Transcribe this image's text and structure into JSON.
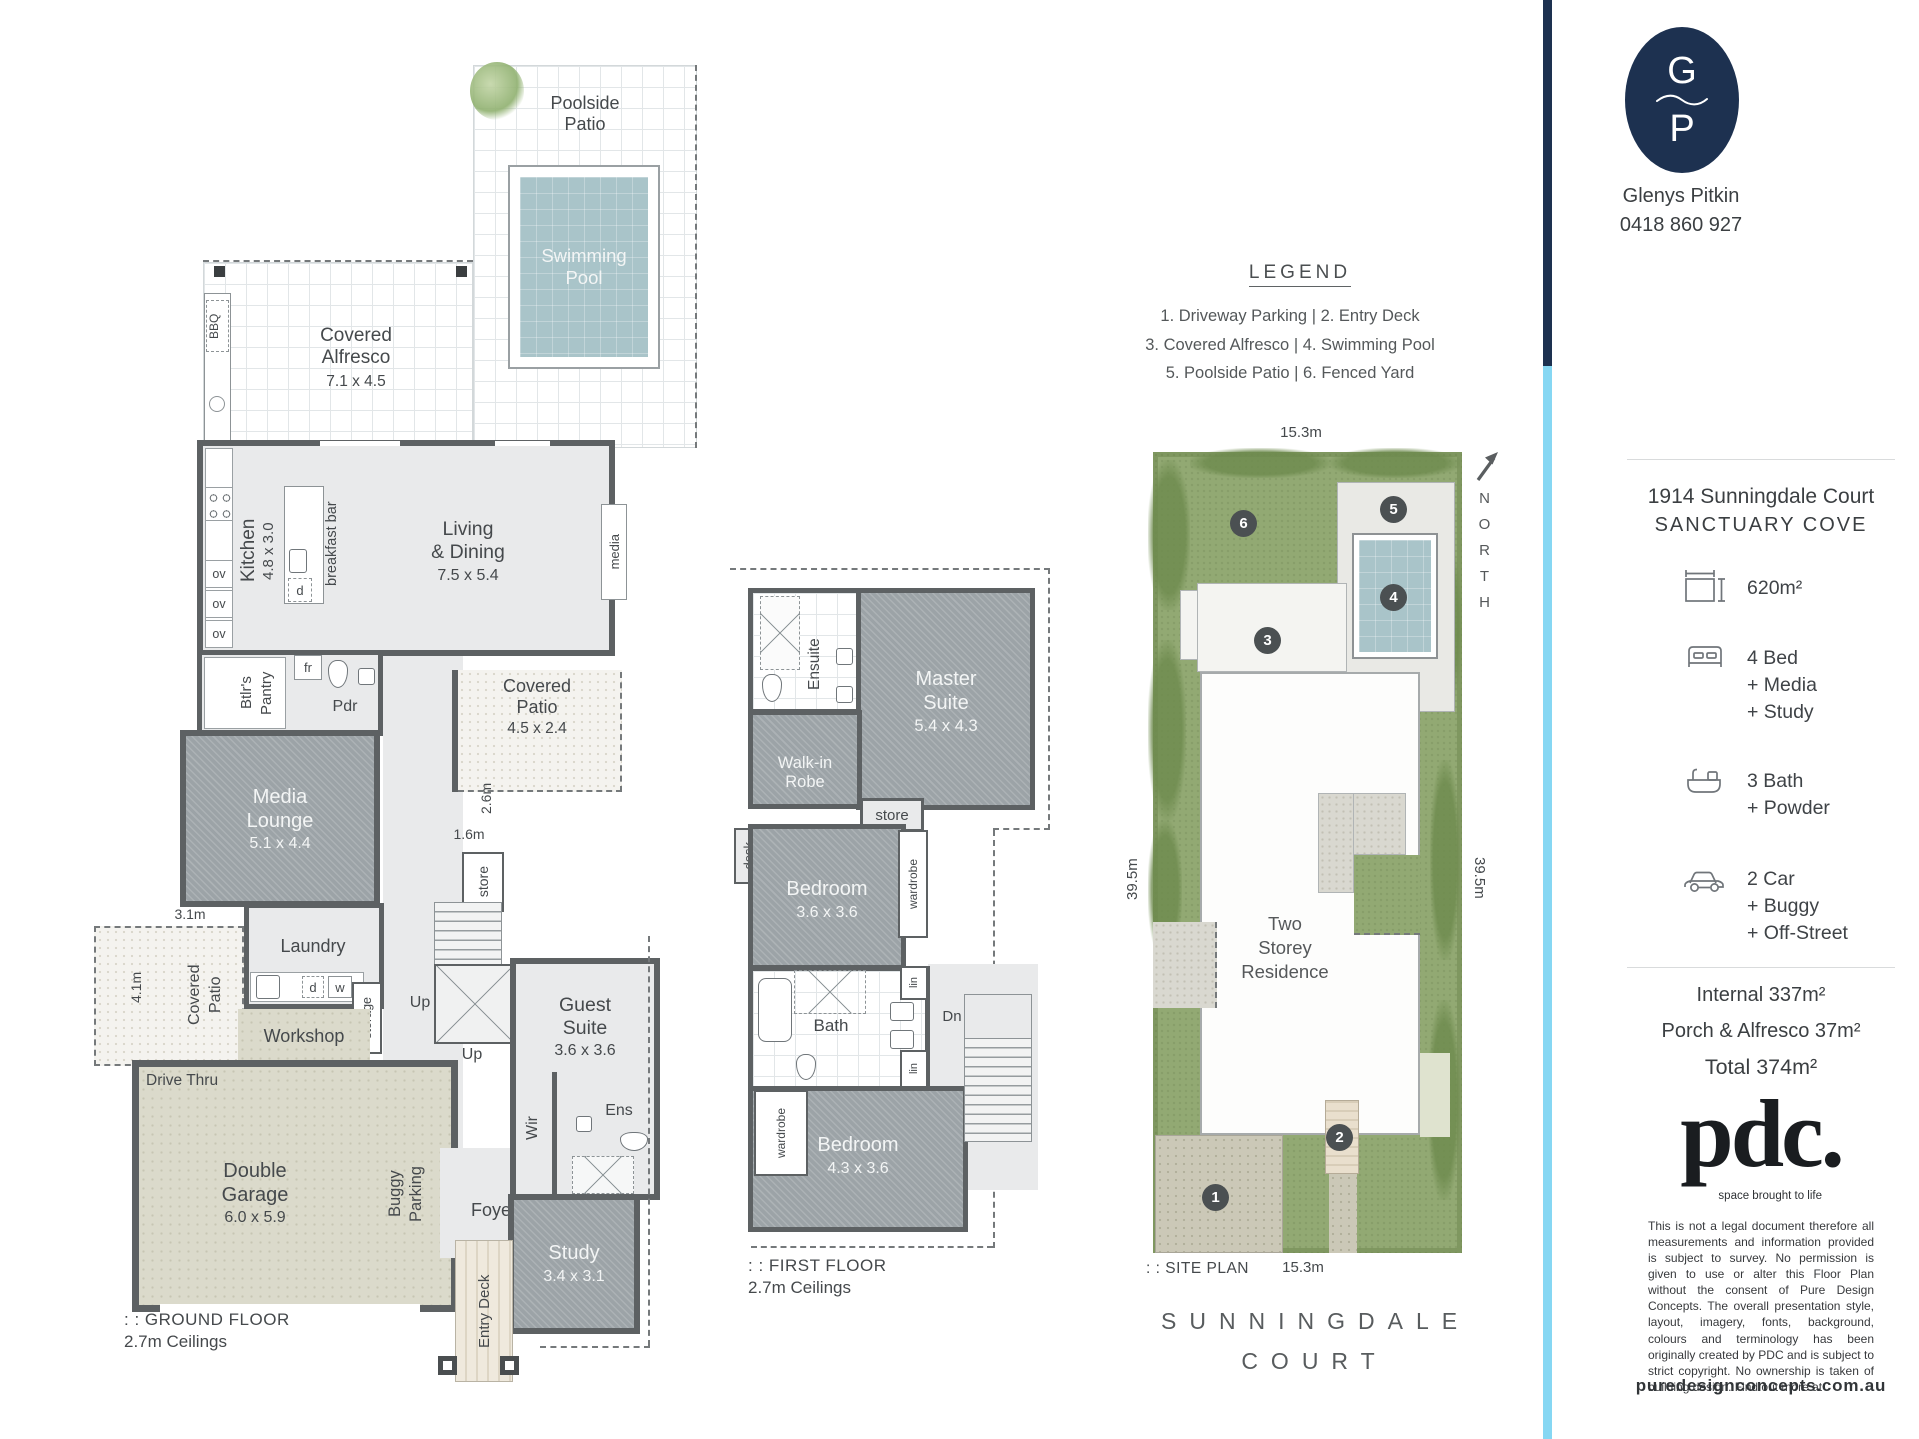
{
  "brand": {
    "logo_top": "G",
    "logo_bottom": "P",
    "name": "Glenys Pitkin",
    "phone": "0418 860 927"
  },
  "lg": {
    "title": "LEGEND",
    "rows": [
      "1. Driveway Parking   |   2. Entry Deck",
      "3. Covered Alfresco   |   4. Swimming Pool",
      "5. Poolside Patio   |   6. Fenced Yard"
    ]
  },
  "g": {
    "poolside": {
      "l1": "Poolside",
      "l2": "Patio"
    },
    "pool": {
      "l1": "Swimming",
      "l2": "Pool"
    },
    "alfresco": {
      "l1": "Covered",
      "l2": "Alfresco",
      "dims": "7.1 x 4.5"
    },
    "bbq": "BBQ",
    "kitchen": {
      "name": "Kitchen",
      "dims": "4.8 x 3.0"
    },
    "breakfast_bar": "breakfast bar",
    "ov": "ov",
    "d": "d",
    "fr": "fr",
    "pantry": {
      "l1": "Btlr's",
      "l2": "Pantry"
    },
    "pdr": "Pdr",
    "living": {
      "l1": "Living",
      "l2": "& Dining",
      "dims": "7.5 x 5.4"
    },
    "media": "media",
    "patio_right": {
      "l1": "Covered",
      "l2": "Patio",
      "dims": "4.5 x 2.4"
    },
    "dim26": "2.6m",
    "dim16": "1.6m",
    "store": "store",
    "media_lounge": {
      "l1": "Media",
      "l2": "Lounge",
      "dims": "5.1 x 4.4"
    },
    "dim31": "3.1m",
    "dim41": "4.1m",
    "patio_left": {
      "l1": "Covered",
      "l2": "Patio"
    },
    "laundry": "Laundry",
    "w": "w",
    "storage": "storage",
    "workshop": "Workshop",
    "up": "Up",
    "drive_thru": "Drive Thru",
    "garage": {
      "l1": "Double",
      "l2": "Garage",
      "dims": "6.0 x 5.9"
    },
    "buggy": {
      "l1": "Buggy",
      "l2": "Parking"
    },
    "foyer": "Foyer",
    "guest": {
      "l1": "Guest",
      "l2": "Suite",
      "dims": "3.6 x 3.6"
    },
    "wir": "Wir",
    "ens": "Ens",
    "study": {
      "name": "Study",
      "dims": "3.4 x 3.1"
    },
    "entry_deck": "Entry Deck",
    "title": ": : GROUND FLOOR",
    "ceilings": "2.7m Ceilings"
  },
  "f": {
    "ensuite": "Ensuite",
    "master": {
      "l1": "Master",
      "l2": "Suite",
      "dims": "5.4 x 4.3"
    },
    "walkin": {
      "l1": "Walk-in",
      "l2": "Robe"
    },
    "store": "store",
    "desk": "desk",
    "wardrobe": "wardrobe",
    "lin": "lin",
    "bed1": {
      "name": "Bedroom",
      "dims": "3.6 x 3.6"
    },
    "bath": "Bath",
    "dn": "Dn",
    "bed2": {
      "name": "Bedroom",
      "dims": "4.3 x 3.6"
    },
    "title": ": : FIRST FLOOR",
    "ceilings": "2.7m Ceilings"
  },
  "s": {
    "dim_top": "15.3m",
    "dim_bottom": "15.3m",
    "dim_left": "39.5m",
    "dim_right": "39.5m",
    "residence": {
      "l1": "Two",
      "l2": "Storey",
      "l3": "Residence"
    },
    "markers": [
      "1",
      "2",
      "3",
      "4",
      "5",
      "6"
    ],
    "north": "NORTH",
    "title": ": : SITE PLAN",
    "street1": "SUNNINGDALE",
    "street2": "COURT"
  },
  "sb": {
    "address1": "1914 Sunningdale Court",
    "address2": "SANCTUARY COVE",
    "land": "620m²",
    "bed": [
      "4 Bed",
      "+ Media",
      "+ Study"
    ],
    "bath": [
      "3 Bath",
      "+ Powder"
    ],
    "car": [
      "2 Car",
      "+ Buggy",
      "+ Off-Street"
    ],
    "internal": "Internal 337m²",
    "porch": "Porch & Alfresco 37m²",
    "total": "Total 374m²",
    "pdc": "pdc.",
    "tagline": "space brought to life",
    "disclaimer": "This is not a legal document therefore all measurements and information provided is subject to survey. No permission is given to use or alter this Floor Plan without the consent of Pure Design Concepts. The overall presentation style, layout, imagery, fonts, background, colours and terminology has been originally created by PDC and is subject to strict copyright. No ownership is taken of building design. Find out more at",
    "website": "puredesignconcepts.com.au"
  },
  "colors": {
    "navy": "#1d3150",
    "lightblue": "#86d7f3",
    "lawn": "#92a973",
    "pool": "#a9c4c9",
    "carpet": "#9ca3a7",
    "wall": "#5d6163",
    "text": "#45494c"
  }
}
